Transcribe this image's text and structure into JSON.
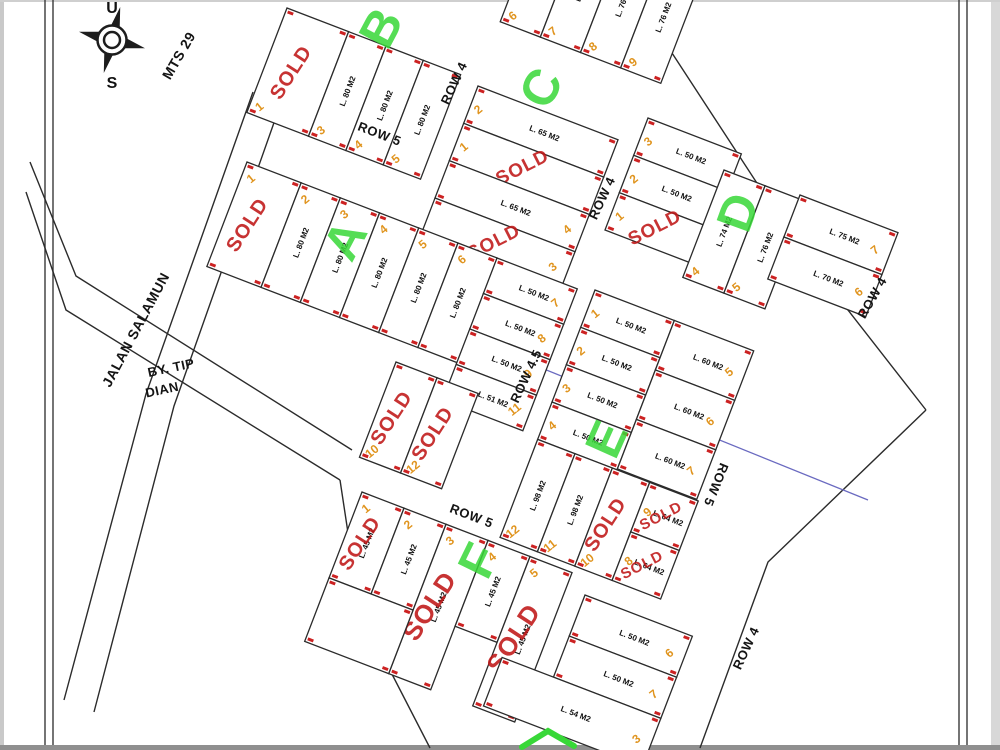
{
  "title": "Site plan - housing plot map",
  "compass": {
    "north_label": "U",
    "south_label": "S"
  },
  "sold_label": "SOLD",
  "colors": {
    "line": "#2b2b2b",
    "sold": "#c01818",
    "number": "#e0941e",
    "letter": "#38d838",
    "marker": "#cc2222",
    "blue": "#6a6ac0",
    "paper": "#ffffff"
  },
  "labels": [
    {
      "id": "mts-29",
      "text": "MTS 29",
      "x": 183,
      "y": 58,
      "rot": -60,
      "size": 14
    },
    {
      "id": "jalan-salamun",
      "text": "JALAN SALAMUN",
      "x": 140,
      "y": 332,
      "rot": -62,
      "size": 14
    },
    {
      "id": "by-tip",
      "text": "BY. TIP",
      "x": 172,
      "y": 372,
      "rot": -12,
      "size": 13
    },
    {
      "id": "dian",
      "text": "DIAN",
      "x": 163,
      "y": 394,
      "rot": -12,
      "size": 13
    },
    {
      "id": "row-5-upper",
      "text": "ROW 5",
      "x": 378,
      "y": 138,
      "rot": 21,
      "size": 13
    },
    {
      "id": "row-4-upper",
      "text": "ROW 4",
      "x": 458,
      "y": 85,
      "rot": -65,
      "size": 13
    },
    {
      "id": "row-4-mid",
      "text": "ROW 4",
      "x": 606,
      "y": 200,
      "rot": -65,
      "size": 13
    },
    {
      "id": "row-4-east",
      "text": "ROW 4",
      "x": 876,
      "y": 300,
      "rot": -60,
      "size": 13
    },
    {
      "id": "row-4-south",
      "text": "ROW 4",
      "x": 750,
      "y": 650,
      "rot": -65,
      "size": 13
    },
    {
      "id": "row-4-5",
      "text": "ROW 4.5",
      "x": 530,
      "y": 378,
      "rot": -65,
      "size": 13
    },
    {
      "id": "row-5-lower",
      "text": "ROW 5",
      "x": 470,
      "y": 520,
      "rot": 21,
      "size": 13
    },
    {
      "id": "row-5-east",
      "text": "ROW 5",
      "x": 712,
      "y": 483,
      "rot": 112,
      "size": 13
    }
  ],
  "block_letters": [
    {
      "letter": "A",
      "x": 360,
      "y": 248,
      "rot": -62
    },
    {
      "letter": "B",
      "x": 396,
      "y": 36,
      "rot": -62
    },
    {
      "letter": "C",
      "x": 556,
      "y": 96,
      "rot": -62
    },
    {
      "letter": "D",
      "x": 754,
      "y": 218,
      "rot": -70
    },
    {
      "letter": "E",
      "x": 622,
      "y": 446,
      "rot": -66
    },
    {
      "letter": "F",
      "x": 494,
      "y": 568,
      "rot": -64
    }
  ],
  "boundary_lines": [
    "M 640,4 L 798,246 L 926,410",
    "M 926,410 L 768,562 L 700,748",
    "M 253,92 L 146,394 L 64,700",
    "M 282,100 L 174,406 L 94,712",
    "M 30,162 L 76,276 L 352,450",
    "M 26,192 L 66,310 L 340,480",
    "M 340,480 L 360,612 L 430,748"
  ],
  "utility_line": "M 393,308 L 868,500",
  "green_mark": "M 522,747 L 548,731 L 574,746",
  "blocks": [
    {
      "name": "block-b",
      "anchor": [
        287,
        8
      ],
      "rot": 21,
      "vert": true,
      "ph": 112,
      "plots": [
        {
          "x": 0,
          "w": 66,
          "num": "1",
          "sold": true,
          "numAt": "bottom"
        },
        {
          "x": 66,
          "w": 40,
          "num": "3",
          "area": "L. 80 M2",
          "numAt": "bottom"
        },
        {
          "x": 106,
          "w": 40,
          "num": "4",
          "area": "L. 80 M2",
          "numAt": "bottom"
        },
        {
          "x": 146,
          "w": 40,
          "num": "5",
          "area": "L. 80 M2",
          "numAt": "bottom"
        }
      ]
    },
    {
      "name": "block-b-east",
      "anchor": [
        545,
        -95
      ],
      "rot": 21,
      "vert": true,
      "ph": 125,
      "plots": [
        {
          "x": 0,
          "w": 43,
          "num": "6",
          "area": "L. 76 M2",
          "numAt": "bottom"
        },
        {
          "x": 43,
          "w": 43,
          "num": "7",
          "area": "L. 76 M2",
          "numAt": "bottom"
        },
        {
          "x": 86,
          "w": 43,
          "num": "8",
          "area": "L. 76 M2",
          "numAt": "bottom"
        },
        {
          "x": 129,
          "w": 43,
          "num": "9",
          "area": "L. 76 M2",
          "numAt": "bottom"
        }
      ]
    },
    {
      "name": "block-c",
      "anchor": [
        478,
        86
      ],
      "rot": 21,
      "pw": 150,
      "plots": [
        {
          "y": 0,
          "h": 40,
          "num": "2",
          "area": "L. 65 M2",
          "numAt": "left"
        },
        {
          "y": 40,
          "h": 40,
          "num": "1",
          "sold": true,
          "numAt": "left"
        },
        {
          "y": 80,
          "h": 40,
          "num": "4",
          "area": "L. 65 M2",
          "numAt": "right"
        },
        {
          "y": 120,
          "h": 40,
          "num": "3",
          "sold": true,
          "numAt": "right"
        }
      ]
    },
    {
      "name": "block-d-west",
      "anchor": [
        648,
        118
      ],
      "rot": 21,
      "pw": 100,
      "plots": [
        {
          "y": 0,
          "h": 40,
          "num": "3",
          "area": "L. 50 M2",
          "numAt": "left"
        },
        {
          "y": 40,
          "h": 40,
          "num": "2",
          "area": "L. 50 M2",
          "numAt": "left"
        },
        {
          "y": 80,
          "h": 40,
          "num": "1",
          "sold": true,
          "numAt": "left"
        }
      ]
    },
    {
      "name": "block-d-mid",
      "anchor": [
        724,
        170
      ],
      "rot": 21,
      "vert": true,
      "ph": 115,
      "plots": [
        {
          "x": 0,
          "w": 44,
          "num": "4",
          "area": "L. 74 M2",
          "numAt": "bottom"
        },
        {
          "x": 44,
          "w": 44,
          "num": "5",
          "area": "L. 76 M2",
          "numAt": "bottom"
        }
      ]
    },
    {
      "name": "block-d-east",
      "anchor": [
        800,
        195
      ],
      "rot": 21,
      "pw": 105,
      "plots": [
        {
          "y": 0,
          "h": 45,
          "num": "7",
          "area": "L. 75 M2",
          "numAt": "right"
        },
        {
          "y": 45,
          "h": 45,
          "num": "6",
          "area": "L. 70 M2",
          "numAt": "right"
        }
      ]
    },
    {
      "name": "block-a",
      "anchor": [
        247,
        162
      ],
      "rot": 21,
      "vert": true,
      "ph": 112,
      "plots": [
        {
          "x": 0,
          "w": 58,
          "num": "1",
          "sold": true,
          "numAt": "top"
        },
        {
          "x": 58,
          "w": 42,
          "num": "2",
          "area": "L. 80 M2",
          "numAt": "top"
        },
        {
          "x": 100,
          "w": 42,
          "num": "3",
          "area": "L. 80 M2",
          "numAt": "top"
        },
        {
          "x": 142,
          "w": 42,
          "num": "4",
          "area": "L. 80 M2",
          "numAt": "top"
        },
        {
          "x": 184,
          "w": 42,
          "num": "5",
          "area": "L. 80 M2",
          "numAt": "top"
        },
        {
          "x": 226,
          "w": 42,
          "num": "6",
          "area": "L. 80 M2",
          "numAt": "top"
        }
      ]
    },
    {
      "name": "block-a-east",
      "anchor": [
        497,
        258
      ],
      "rot": 21,
      "pw": 86,
      "plots": [
        {
          "y": 0,
          "h": 38,
          "num": "7",
          "area": "L. 50 M2",
          "numAt": "right"
        },
        {
          "y": 38,
          "h": 38,
          "num": "8",
          "area": "L. 50 M2",
          "numAt": "right"
        },
        {
          "y": 76,
          "h": 38,
          "num": "9",
          "area": "L. 50 M2",
          "numAt": "right"
        },
        {
          "y": 114,
          "h": 38,
          "num": "11",
          "area": "L. 51 M2",
          "numAt": "right"
        }
      ]
    },
    {
      "name": "block-a-sold",
      "anchor": [
        396,
        362
      ],
      "rot": 21,
      "vert": true,
      "ph": 102,
      "plots": [
        {
          "x": 0,
          "w": 44,
          "num": "10",
          "sold": true,
          "numAt": "bottom"
        },
        {
          "x": 44,
          "w": 44,
          "num": "12",
          "sold": true,
          "numAt": "bottom"
        }
      ]
    },
    {
      "name": "block-e",
      "anchor": [
        595,
        290
      ],
      "rot": 21,
      "plots": [
        {
          "x": 0,
          "y": 0,
          "w": 85,
          "h": 40,
          "num": "1",
          "area": "L. 50 M2",
          "numAt": "left"
        },
        {
          "x": 0,
          "y": 40,
          "w": 85,
          "h": 40,
          "num": "2",
          "area": "L. 50 M2",
          "numAt": "left"
        },
        {
          "x": 0,
          "y": 80,
          "w": 85,
          "h": 40,
          "num": "3",
          "area": "L. 50 M2",
          "numAt": "left"
        },
        {
          "x": 0,
          "y": 120,
          "w": 85,
          "h": 40,
          "num": "4",
          "area": "L. 50 M2",
          "numAt": "left"
        },
        {
          "x": 85,
          "y": 0,
          "w": 85,
          "h": 53,
          "num": "5",
          "area": "L. 60 M2",
          "numAt": "right"
        },
        {
          "x": 85,
          "y": 53,
          "w": 85,
          "h": 53,
          "num": "6",
          "area": "L. 60 M2",
          "numAt": "right"
        },
        {
          "x": 85,
          "y": 106,
          "w": 85,
          "h": 53,
          "num": "7",
          "area": "L. 60 M2",
          "numAt": "right"
        },
        {
          "x": 0,
          "y": 160,
          "w": 40,
          "h": 105,
          "num": "12",
          "area": "L. 98 M2",
          "vert": true,
          "numAt": "bottom"
        },
        {
          "x": 40,
          "y": 160,
          "w": 40,
          "h": 105,
          "num": "11",
          "area": "L. 98 M2",
          "vert": true,
          "numAt": "bottom"
        },
        {
          "x": 80,
          "y": 160,
          "w": 40,
          "h": 105,
          "num": "10",
          "sold": true,
          "vert": true,
          "numAt": "bottom"
        },
        {
          "x": 120,
          "y": 160,
          "w": 52,
          "h": 53,
          "num": "9",
          "sold": true,
          "area": "L. 64 M2",
          "numAt": "left"
        },
        {
          "x": 120,
          "y": 213,
          "w": 52,
          "h": 52,
          "num": "8",
          "sold": true,
          "area": "L. 64 M2",
          "numAt": "left"
        }
      ]
    },
    {
      "name": "block-f",
      "anchor": [
        362,
        492
      ],
      "rot": 21,
      "vert": true,
      "ph": 92,
      "plots": [
        {
          "x": 0,
          "w": 45,
          "num": "1",
          "sold": true,
          "area": "L. 45 M2",
          "numAt": "top"
        },
        {
          "x": 45,
          "w": 45,
          "num": "2",
          "area": "L. 45 M2",
          "numAt": "top"
        },
        {
          "x": 90,
          "w": 45,
          "h": 160,
          "num": "3",
          "sold": true,
          "area": "L. 45 M2",
          "numAt": "top"
        },
        {
          "x": 135,
          "w": 45,
          "num": "4",
          "area": "L. 45 M2",
          "numAt": "top"
        },
        {
          "x": 180,
          "w": 45,
          "h": 160,
          "num": "5",
          "sold": true,
          "area": "L. 45 M2",
          "numAt": "top"
        },
        {
          "x": 0,
          "y": 92,
          "w": 90,
          "h": 68
        }
      ]
    },
    {
      "name": "block-f-east",
      "anchor": [
        585,
        595
      ],
      "rot": 21,
      "plots": [
        {
          "x": 0,
          "y": 0,
          "w": 115,
          "h": 44,
          "num": "6",
          "area": "L. 50 M2",
          "numAt": "right"
        },
        {
          "x": 0,
          "y": 44,
          "w": 115,
          "h": 44,
          "num": "7",
          "area": "L. 50 M2",
          "numAt": "right"
        },
        {
          "x": -55,
          "y": 88,
          "w": 170,
          "h": 52,
          "num": "3",
          "area": "L. 54 M2",
          "numAt": "right"
        }
      ]
    }
  ]
}
